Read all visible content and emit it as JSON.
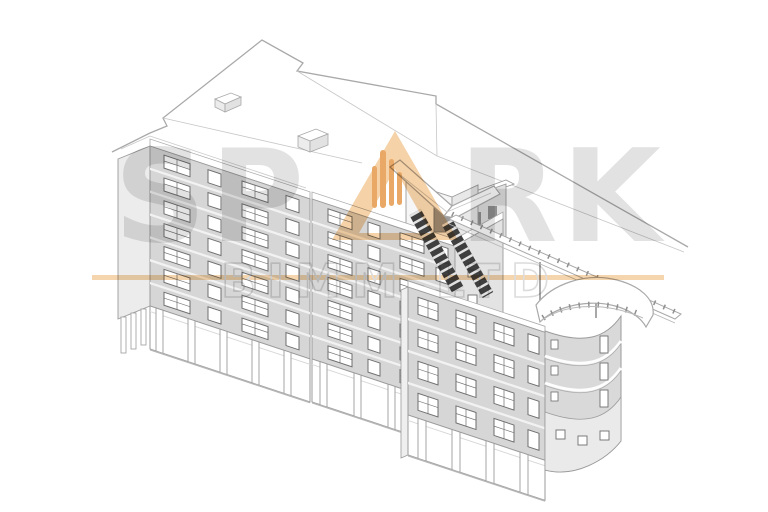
{
  "watermark": {
    "brand": "SPARK",
    "brand_left": "SP",
    "brand_right": "RK",
    "subtitle": "BIMM LTD",
    "brand_color": "#e2e2e2",
    "a_fill": "#f5d2a8",
    "flame_color": "#e9a865",
    "underline_color": "#f4d5ae",
    "subtitle_color": "#dcdcdc"
  },
  "palette": {
    "background": "#ffffff",
    "facade": "#d6d6d6",
    "facade_light": "#ececec",
    "facade_end": "#e3e3e3",
    "roof": "#ffffff",
    "line": "#9b9b9b",
    "roof_line": "#b3b3b3",
    "window_frame": "#6f6f6f",
    "glass": "#ffffff",
    "stair_dark": "#3f3f3f",
    "band": "#f2f2f2"
  }
}
